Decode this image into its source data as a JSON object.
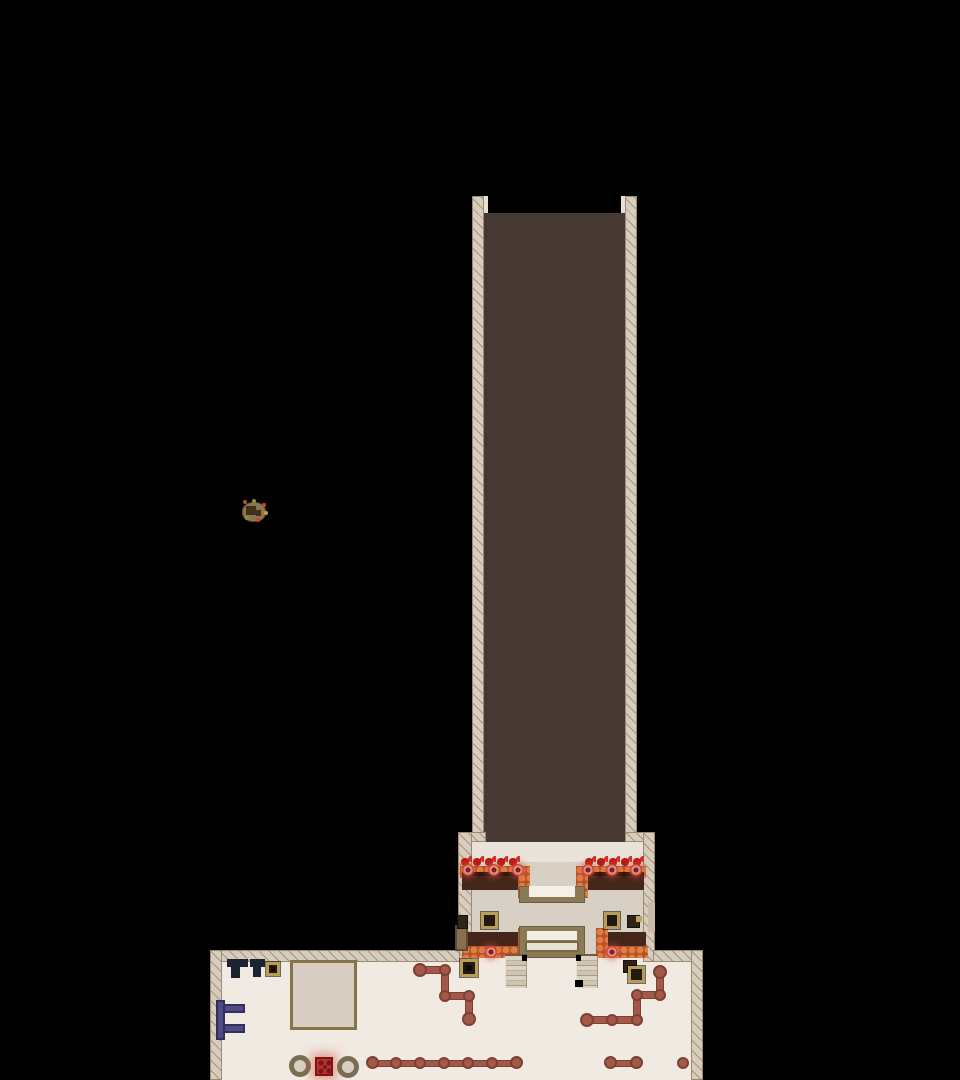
{
  "meta": {
    "scene": "top-down pixel game map: dark corridor descending into a lobby with flower planters and reception desk, opening into a large hall",
    "visible_text": "none"
  },
  "palette": {
    "void": "#000000",
    "corridor_floor": "#463833",
    "wall": "#d8ccbd",
    "lobby_floor": "#d9d0c5",
    "hall_floor": "#f0eae3",
    "planter_soil": "#45261a",
    "planter_trim_orange": "#d2693c",
    "flower_red": "#b91a16",
    "medallion_pink": "#d9918f",
    "pipe_rust": "#a3584a",
    "crate_trim": "#b99d55",
    "navy_table": "#1b2330",
    "purple_rack": "#504b83",
    "pot_rim": "#7a6e52",
    "hazard_red": "#b23230",
    "frame_olive": "#8a7a55"
  },
  "map": {
    "width": 960,
    "height": 1080,
    "background": "#000000",
    "shapes": [
      {
        "n": "corridor-floor",
        "t": "r",
        "x": 484,
        "y": 213,
        "w": 141,
        "h": 629,
        "f": "#463833"
      },
      {
        "n": "lobby-floor",
        "t": "r",
        "x": 470,
        "y": 842,
        "w": 173,
        "h": 116,
        "f": "#d9d0c5"
      },
      {
        "n": "lobby-floor-top",
        "t": "r",
        "x": 470,
        "y": 842,
        "w": 173,
        "h": 20,
        "f": "#eae3d9"
      },
      {
        "n": "hall-floor",
        "t": "r",
        "x": 222,
        "y": 958,
        "w": 469,
        "h": 122,
        "f": "#f0eae3"
      },
      {
        "n": "corridor-left-wall",
        "t": "r",
        "x": 472,
        "y": 196,
        "w": 12,
        "h": 646,
        "c": "wall"
      },
      {
        "n": "corridor-right-wall",
        "t": "r",
        "x": 625,
        "y": 196,
        "w": 12,
        "h": 646,
        "c": "wall"
      },
      {
        "n": "corridor-left-wall-cap",
        "t": "r",
        "x": 484,
        "y": 196,
        "w": 4,
        "h": 17,
        "f": "#e9dfd2"
      },
      {
        "n": "corridor-right-wall-cap",
        "t": "r",
        "x": 621,
        "y": 196,
        "w": 4,
        "h": 17,
        "f": "#e9dfd2"
      },
      {
        "n": "lobby-left-wall-step",
        "t": "r",
        "x": 458,
        "y": 832,
        "w": 28,
        "h": 10,
        "c": "wall"
      },
      {
        "n": "lobby-right-wall-step",
        "t": "r",
        "x": 625,
        "y": 832,
        "w": 30,
        "h": 10,
        "c": "wall"
      },
      {
        "n": "lobby-left-wall",
        "t": "r",
        "x": 458,
        "y": 832,
        "w": 14,
        "h": 130,
        "c": "wall"
      },
      {
        "n": "lobby-right-wall",
        "t": "r",
        "x": 643,
        "y": 832,
        "w": 12,
        "h": 130,
        "c": "wall"
      },
      {
        "n": "hall-top-wall-left",
        "t": "r",
        "x": 210,
        "y": 950,
        "w": 250,
        "h": 12,
        "c": "wall"
      },
      {
        "n": "hall-top-wall-right",
        "t": "r",
        "x": 653,
        "y": 950,
        "w": 50,
        "h": 12,
        "c": "wall"
      },
      {
        "n": "hall-left-wall",
        "t": "r",
        "x": 210,
        "y": 950,
        "w": 12,
        "h": 130,
        "c": "wall"
      },
      {
        "n": "hall-right-wall",
        "t": "r",
        "x": 691,
        "y": 950,
        "w": 12,
        "h": 130,
        "c": "wall"
      },
      {
        "n": "lobby-right-wall-niche",
        "t": "r",
        "x": 648,
        "y": 902,
        "w": 7,
        "h": 30,
        "f": "#c9bba7"
      },
      {
        "n": "planter-tl-flowers",
        "t": "r",
        "x": 460,
        "y": 856,
        "w": 60,
        "h": 13,
        "c": "flowers"
      },
      {
        "n": "planter-tl-trim-top",
        "t": "r",
        "x": 460,
        "y": 866,
        "w": 70,
        "h": 12,
        "c": "scallop"
      },
      {
        "n": "planter-tl-soil",
        "t": "r",
        "x": 462,
        "y": 872,
        "w": 58,
        "h": 18,
        "f": "#45261a"
      },
      {
        "n": "planter-tl-soil-shade",
        "t": "r",
        "x": 462,
        "y": 872,
        "w": 58,
        "h": 4,
        "f": "#2f150c"
      },
      {
        "n": "planter-tl-trim-right",
        "t": "r",
        "x": 518,
        "y": 866,
        "w": 12,
        "h": 32,
        "c": "scallop"
      },
      {
        "n": "planter-tl-medallion-1",
        "t": "c",
        "x": 462,
        "y": 864,
        "w": 12,
        "h": 12,
        "c": "medallion"
      },
      {
        "n": "planter-tl-medallion-2",
        "t": "c",
        "x": 488,
        "y": 864,
        "w": 12,
        "h": 12,
        "c": "medallion"
      },
      {
        "n": "planter-tl-medallion-3",
        "t": "c",
        "x": 512,
        "y": 864,
        "w": 12,
        "h": 12,
        "c": "medallion"
      },
      {
        "n": "planter-tr-flowers",
        "t": "r",
        "x": 584,
        "y": 856,
        "w": 60,
        "h": 13,
        "c": "flowers"
      },
      {
        "n": "planter-tr-trim-top",
        "t": "r",
        "x": 576,
        "y": 866,
        "w": 70,
        "h": 12,
        "c": "scallop"
      },
      {
        "n": "planter-tr-soil",
        "t": "r",
        "x": 586,
        "y": 872,
        "w": 58,
        "h": 18,
        "f": "#45261a"
      },
      {
        "n": "planter-tr-soil-shade",
        "t": "r",
        "x": 586,
        "y": 872,
        "w": 58,
        "h": 4,
        "f": "#2f150c"
      },
      {
        "n": "planter-tr-trim-left",
        "t": "r",
        "x": 576,
        "y": 866,
        "w": 12,
        "h": 32,
        "c": "scallop"
      },
      {
        "n": "planter-tr-medallion-1",
        "t": "c",
        "x": 582,
        "y": 864,
        "w": 12,
        "h": 12,
        "c": "medallion"
      },
      {
        "n": "planter-tr-medallion-2",
        "t": "c",
        "x": 606,
        "y": 864,
        "w": 12,
        "h": 12,
        "c": "medallion"
      },
      {
        "n": "planter-tr-medallion-3",
        "t": "c",
        "x": 630,
        "y": 864,
        "w": 12,
        "h": 12,
        "c": "medallion"
      },
      {
        "n": "planter-bl-soil",
        "t": "r",
        "x": 464,
        "y": 932,
        "w": 56,
        "h": 20,
        "f": "#45261a"
      },
      {
        "n": "planter-bl-trim-bottom",
        "t": "r",
        "x": 462,
        "y": 946,
        "w": 68,
        "h": 12,
        "c": "scallop"
      },
      {
        "n": "planter-bl-trim-right",
        "t": "r",
        "x": 518,
        "y": 928,
        "w": 12,
        "h": 30,
        "c": "scallop"
      },
      {
        "n": "planter-bl-medallion",
        "t": "c",
        "x": 485,
        "y": 946,
        "w": 12,
        "h": 12,
        "c": "medallion"
      },
      {
        "n": "planter-br-soil",
        "t": "r",
        "x": 600,
        "y": 932,
        "w": 46,
        "h": 20,
        "f": "#45261a"
      },
      {
        "n": "planter-br-trim-bottom",
        "t": "r",
        "x": 596,
        "y": 946,
        "w": 52,
        "h": 12,
        "c": "scallop"
      },
      {
        "n": "planter-br-trim-left",
        "t": "r",
        "x": 596,
        "y": 928,
        "w": 12,
        "h": 30,
        "c": "scallop"
      },
      {
        "n": "planter-br-medallion",
        "t": "c",
        "x": 606,
        "y": 946,
        "w": 12,
        "h": 12,
        "c": "medallion"
      },
      {
        "n": "entry-pedestal-frame",
        "t": "r",
        "x": 519,
        "y": 886,
        "w": 66,
        "h": 17,
        "f": "#8a7a55",
        "b": "1px solid #6e5f3e"
      },
      {
        "n": "entry-pedestal-top",
        "t": "r",
        "x": 529,
        "y": 886,
        "w": 46,
        "h": 11,
        "f": "#f6f1e7"
      },
      {
        "n": "reception-desk-frame",
        "t": "r",
        "x": 519,
        "y": 926,
        "w": 66,
        "h": 32,
        "f": "#8a7a55",
        "b": "1px solid #6e5f3e"
      },
      {
        "n": "reception-desk-top",
        "t": "r",
        "x": 527,
        "y": 931,
        "w": 50,
        "h": 9,
        "f": "#f3eee4"
      },
      {
        "n": "reception-desk-counter",
        "t": "r",
        "x": 525,
        "y": 941,
        "w": 54,
        "h": 11,
        "f": "#e9e2d4",
        "b": "2px solid #77683f"
      },
      {
        "n": "lobby-side-door",
        "t": "r",
        "x": 455,
        "y": 925,
        "w": 13,
        "h": 26,
        "f": "#8a6f4f",
        "b": "2px solid #5f4a33",
        "i": true
      },
      {
        "n": "stairs-left",
        "t": "r",
        "x": 505,
        "y": 954,
        "w": 22,
        "h": 34,
        "c": "stairs",
        "i": true
      },
      {
        "n": "stairs-right",
        "t": "r",
        "x": 576,
        "y": 954,
        "w": 22,
        "h": 34,
        "c": "stairs",
        "i": true
      },
      {
        "n": "stairs-left-shadow",
        "t": "r",
        "x": 522,
        "y": 955,
        "w": 5,
        "h": 6,
        "f": "#000000"
      },
      {
        "n": "stairs-right-shadow",
        "t": "r",
        "x": 576,
        "y": 955,
        "w": 5,
        "h": 6,
        "f": "#000000"
      },
      {
        "n": "stairs-right-shadow-2",
        "t": "r",
        "x": 575,
        "y": 980,
        "w": 8,
        "h": 7,
        "f": "#000000"
      },
      {
        "n": "crate-lobby-left-small",
        "t": "r",
        "x": 457,
        "y": 915,
        "w": 11,
        "h": 14,
        "c": "crate-dark",
        "i": true
      },
      {
        "n": "crate-lobby-left",
        "t": "r",
        "x": 481,
        "y": 912,
        "w": 17,
        "h": 17,
        "c": "crate",
        "i": true
      },
      {
        "n": "crate-lobby-right",
        "t": "r",
        "x": 604,
        "y": 912,
        "w": 16,
        "h": 17,
        "c": "crate",
        "i": true
      },
      {
        "n": "crate-lobby-right-small",
        "t": "r",
        "x": 627,
        "y": 915,
        "w": 13,
        "h": 13,
        "c": "crate-dark",
        "i": true
      },
      {
        "n": "crate-lobby-right-flap",
        "t": "r",
        "x": 636,
        "y": 916,
        "w": 6,
        "h": 6,
        "f": "#bfa45f"
      },
      {
        "n": "table-1-top",
        "t": "r",
        "x": 227,
        "y": 959,
        "w": 21,
        "h": 8,
        "c": "navy"
      },
      {
        "n": "table-1-leg",
        "t": "r",
        "x": 231,
        "y": 967,
        "w": 9,
        "h": 11,
        "c": "navy"
      },
      {
        "n": "table-2-top",
        "t": "r",
        "x": 250,
        "y": 959,
        "w": 15,
        "h": 8,
        "c": "navy"
      },
      {
        "n": "table-2-leg",
        "t": "r",
        "x": 253,
        "y": 967,
        "w": 8,
        "h": 10,
        "c": "navy"
      },
      {
        "n": "crate-hall-top",
        "t": "r",
        "x": 266,
        "y": 962,
        "w": 14,
        "h": 14,
        "c": "crate",
        "i": true
      },
      {
        "n": "crate-hall-top-dot",
        "t": "r",
        "x": 271,
        "y": 967,
        "w": 4,
        "h": 4,
        "f": "#0f0c08"
      },
      {
        "n": "floor-platform",
        "t": "r",
        "x": 290,
        "y": 960,
        "w": 67,
        "h": 70,
        "c": "platform"
      },
      {
        "n": "wall-rack-post",
        "t": "r",
        "x": 216,
        "y": 1000,
        "w": 9,
        "h": 40,
        "c": "purple"
      },
      {
        "n": "wall-rack-arm-top",
        "t": "r",
        "x": 223,
        "y": 1004,
        "w": 22,
        "h": 9,
        "c": "purple"
      },
      {
        "n": "wall-rack-arm-bottom",
        "t": "r",
        "x": 223,
        "y": 1024,
        "w": 22,
        "h": 9,
        "c": "purple"
      },
      {
        "n": "crate-hall-left",
        "t": "r",
        "x": 460,
        "y": 959,
        "w": 18,
        "h": 18,
        "c": "crate",
        "i": true
      },
      {
        "n": "crate-hall-left-dot",
        "t": "r",
        "x": 466,
        "y": 965,
        "w": 6,
        "h": 6,
        "f": "#0f0c08"
      },
      {
        "n": "crate-hall-right-back",
        "t": "r",
        "x": 623,
        "y": 960,
        "w": 14,
        "h": 13,
        "c": "crate-dark",
        "i": true
      },
      {
        "n": "crate-hall-right",
        "t": "r",
        "x": 628,
        "y": 966,
        "w": 17,
        "h": 17,
        "c": "crate",
        "i": true
      },
      {
        "n": "pipe-zigzag-seg-1",
        "t": "r",
        "x": 417,
        "y": 966,
        "w": 32,
        "h": 8,
        "c": "pipe"
      },
      {
        "n": "pipe-zigzag-seg-2",
        "t": "r",
        "x": 441,
        "y": 967,
        "w": 8,
        "h": 33,
        "c": "pipe"
      },
      {
        "n": "pipe-zigzag-seg-3",
        "t": "r",
        "x": 442,
        "y": 992,
        "w": 31,
        "h": 8,
        "c": "pipe"
      },
      {
        "n": "pipe-zigzag-seg-4",
        "t": "r",
        "x": 465,
        "y": 993,
        "w": 8,
        "h": 30,
        "c": "pipe"
      },
      {
        "n": "pipe-zigzag-cap-1",
        "t": "c",
        "x": 413,
        "y": 963,
        "w": 14,
        "h": 14,
        "c": "pipe-joint"
      },
      {
        "n": "pipe-zigzag-joint-1",
        "t": "c",
        "x": 439,
        "y": 964,
        "w": 12,
        "h": 12,
        "c": "pipe-joint"
      },
      {
        "n": "pipe-zigzag-joint-2",
        "t": "c",
        "x": 439,
        "y": 990,
        "w": 12,
        "h": 12,
        "c": "pipe-joint"
      },
      {
        "n": "pipe-zigzag-joint-3",
        "t": "c",
        "x": 463,
        "y": 990,
        "w": 12,
        "h": 12,
        "c": "pipe-joint"
      },
      {
        "n": "pipe-zigzag-cap-2",
        "t": "c",
        "x": 462,
        "y": 1012,
        "w": 14,
        "h": 14,
        "c": "pipe-joint"
      },
      {
        "n": "pipe-right-seg-1",
        "t": "r",
        "x": 584,
        "y": 1016,
        "w": 56,
        "h": 8,
        "c": "pipe"
      },
      {
        "n": "pipe-right-seg-2",
        "t": "r",
        "x": 633,
        "y": 992,
        "w": 8,
        "h": 30,
        "c": "pipe"
      },
      {
        "n": "pipe-right-seg-3",
        "t": "r",
        "x": 634,
        "y": 991,
        "w": 30,
        "h": 8,
        "c": "pipe"
      },
      {
        "n": "pipe-right-seg-4",
        "t": "r",
        "x": 656,
        "y": 970,
        "w": 8,
        "h": 27,
        "c": "pipe"
      },
      {
        "n": "pipe-right-cap-1",
        "t": "c",
        "x": 580,
        "y": 1013,
        "w": 14,
        "h": 14,
        "c": "pipe-joint"
      },
      {
        "n": "pipe-right-joint-1",
        "t": "c",
        "x": 606,
        "y": 1014,
        "w": 12,
        "h": 12,
        "c": "pipe-joint"
      },
      {
        "n": "pipe-right-joint-2",
        "t": "c",
        "x": 631,
        "y": 1014,
        "w": 12,
        "h": 12,
        "c": "pipe-joint"
      },
      {
        "n": "pipe-right-joint-3",
        "t": "c",
        "x": 631,
        "y": 989,
        "w": 12,
        "h": 12,
        "c": "pipe-joint"
      },
      {
        "n": "pipe-right-joint-4",
        "t": "c",
        "x": 654,
        "y": 989,
        "w": 12,
        "h": 12,
        "c": "pipe-joint"
      },
      {
        "n": "pipe-right-cap-2",
        "t": "c",
        "x": 653,
        "y": 965,
        "w": 14,
        "h": 14,
        "c": "pipe-joint"
      },
      {
        "n": "pipe-bottom-seg",
        "t": "r",
        "x": 370,
        "y": 1060,
        "w": 149,
        "h": 7,
        "c": "pipe"
      },
      {
        "n": "pipe-bottom-cap-1",
        "t": "c",
        "x": 366,
        "y": 1056,
        "w": 13,
        "h": 13,
        "c": "pipe-joint"
      },
      {
        "n": "pipe-bottom-joint-1",
        "t": "c",
        "x": 390,
        "y": 1057,
        "w": 12,
        "h": 12,
        "c": "pipe-joint"
      },
      {
        "n": "pipe-bottom-joint-2",
        "t": "c",
        "x": 414,
        "y": 1057,
        "w": 12,
        "h": 12,
        "c": "pipe-joint"
      },
      {
        "n": "pipe-bottom-joint-3",
        "t": "c",
        "x": 438,
        "y": 1057,
        "w": 12,
        "h": 12,
        "c": "pipe-joint"
      },
      {
        "n": "pipe-bottom-joint-4",
        "t": "c",
        "x": 462,
        "y": 1057,
        "w": 12,
        "h": 12,
        "c": "pipe-joint"
      },
      {
        "n": "pipe-bottom-joint-5",
        "t": "c",
        "x": 486,
        "y": 1057,
        "w": 12,
        "h": 12,
        "c": "pipe-joint"
      },
      {
        "n": "pipe-bottom-cap-2",
        "t": "c",
        "x": 510,
        "y": 1056,
        "w": 13,
        "h": 13,
        "c": "pipe-joint"
      },
      {
        "n": "pipe-short-seg",
        "t": "r",
        "x": 610,
        "y": 1060,
        "w": 28,
        "h": 7,
        "c": "pipe"
      },
      {
        "n": "pipe-short-cap-1",
        "t": "c",
        "x": 604,
        "y": 1056,
        "w": 13,
        "h": 13,
        "c": "pipe-joint"
      },
      {
        "n": "pipe-short-cap-2",
        "t": "c",
        "x": 630,
        "y": 1056,
        "w": 13,
        "h": 13,
        "c": "pipe-joint"
      },
      {
        "n": "pipe-end-dot",
        "t": "c",
        "x": 677,
        "y": 1057,
        "w": 12,
        "h": 12,
        "c": "pipe-joint"
      },
      {
        "n": "pot-left",
        "t": "c",
        "x": 289,
        "y": 1055,
        "w": 22,
        "h": 22,
        "c": "pot",
        "i": true
      },
      {
        "n": "hazard-box",
        "t": "r",
        "x": 315,
        "y": 1057,
        "w": 18,
        "h": 19,
        "c": "redbox",
        "i": true
      },
      {
        "n": "pot-right",
        "t": "c",
        "x": 337,
        "y": 1056,
        "w": 22,
        "h": 22,
        "c": "pot",
        "i": true
      },
      {
        "n": "garden-islet",
        "t": "r",
        "x": 242,
        "y": 502,
        "w": 24,
        "h": 20,
        "c": "island"
      },
      {
        "n": "garden-islet-box",
        "t": "r",
        "x": 246,
        "y": 506,
        "w": 10,
        "h": 9,
        "f": "#443019"
      },
      {
        "n": "garden-islet-box-2",
        "t": "r",
        "x": 256,
        "y": 510,
        "w": 5,
        "h": 6,
        "f": "#443019"
      },
      {
        "n": "garden-islet-dot-1",
        "t": "c",
        "x": 243,
        "y": 500,
        "w": 4,
        "h": 4,
        "f": "#bf4b2e"
      },
      {
        "n": "garden-islet-dot-2",
        "t": "c",
        "x": 252,
        "y": 499,
        "w": 4,
        "h": 4,
        "f": "#7d9a3c"
      },
      {
        "n": "garden-islet-dot-3",
        "t": "c",
        "x": 262,
        "y": 503,
        "w": 4,
        "h": 4,
        "f": "#c8442c"
      },
      {
        "n": "garden-islet-dot-4",
        "t": "c",
        "x": 264,
        "y": 511,
        "w": 4,
        "h": 4,
        "f": "#c8a02c"
      },
      {
        "n": "garden-islet-dot-5",
        "t": "c",
        "x": 256,
        "y": 518,
        "w": 4,
        "h": 4,
        "f": "#bf4b2e"
      },
      {
        "n": "garden-islet-dot-6",
        "t": "c",
        "x": 245,
        "y": 516,
        "w": 4,
        "h": 4,
        "f": "#7d9a3c"
      }
    ]
  }
}
